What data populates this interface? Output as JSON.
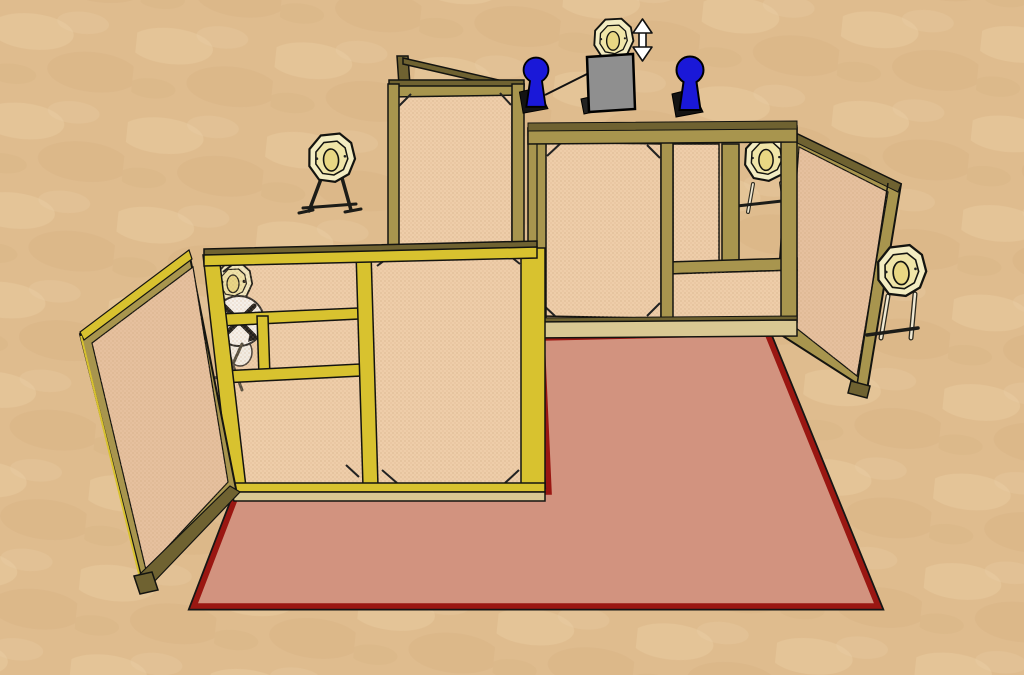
{
  "viewport": {
    "kind": "3d-model-render",
    "style": "sketchup-like shooting-stage design",
    "width": 1024,
    "height": 675
  },
  "colors": {
    "ground": "#dfbc8e",
    "ground_light": "#eacfa6",
    "ground_dark": "#d3ad7c",
    "floor_pink": "#d2937f",
    "fault_red": "#9a1712",
    "frame_bright": "#d8c22f",
    "frame_olive": "#a8954e",
    "frame_dark": "#6f6231",
    "frame_pale": "#d9c893",
    "mesh": "#eecda9",
    "mesh_back": "#e6c09e",
    "mesh_dot": "#c49a72",
    "target_cream": "#f3ecc2",
    "target_mid": "#f0e5a8",
    "target_core": "#e9d783",
    "stand_cream": "#efe8d2",
    "disk_white": "#f7f4ef",
    "popper_blue": "#1a18d8",
    "box_gray": "#8f8f8f",
    "white": "#ffffff",
    "outline": "#141410"
  },
  "scene": {
    "ground": {
      "name": "range-ground",
      "texture": "sand"
    },
    "shooting_area": {
      "name": "shooter-area",
      "shape": "L-shaped",
      "fill_color": "#d2937f",
      "border_color": "#9a1712"
    },
    "walls": [
      {
        "name": "left-wing-wall",
        "type": "framed-mesh-wall",
        "orientation": "angled-toward-viewer-left"
      },
      {
        "name": "left-main-wall",
        "type": "framed-mesh-wall-with-window-port"
      },
      {
        "name": "center-tall-wall",
        "type": "tall-framed-mesh-wall"
      },
      {
        "name": "right-main-wall",
        "type": "framed-mesh-wall"
      },
      {
        "name": "right-port-wall",
        "type": "framed-mesh-wall-with-window-port"
      },
      {
        "name": "right-wing-wall",
        "type": "framed-mesh-wall",
        "orientation": "angled-toward-viewer-right"
      }
    ],
    "targets": [
      {
        "name": "target-left-stand",
        "type": "classic-paper-target",
        "mount": "wood-target-stand"
      },
      {
        "name": "target-swinger",
        "type": "classic-paper-target-on-swinger-disk",
        "position": "behind-left-main-wall"
      },
      {
        "name": "target-up-down",
        "type": "classic-paper-target-vertical-mover",
        "mount": "gray-activator-box",
        "indicator": "white-up-down-arrow"
      },
      {
        "name": "target-right-port",
        "type": "classic-paper-target",
        "mount": "stand-behind-right-port-window"
      },
      {
        "name": "target-far-right",
        "type": "classic-paper-target",
        "mount": "wood-target-stand"
      }
    ],
    "steel": [
      {
        "name": "popper-left",
        "type": "pepper-popper",
        "color": "#1a18d8",
        "note": "cable runs to activator box"
      },
      {
        "name": "popper-right",
        "type": "pepper-popper",
        "color": "#1a18d8"
      }
    ],
    "mechanisms": [
      {
        "name": "activator-cable",
        "from": "popper-left",
        "to": "activator-box"
      },
      {
        "name": "activator-box",
        "color": "#8f8f8f"
      }
    ]
  }
}
